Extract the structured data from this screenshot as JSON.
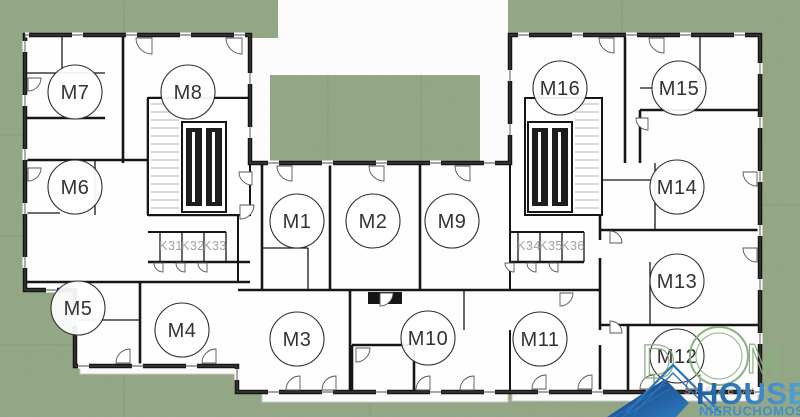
{
  "units": [
    "M1",
    "M2",
    "M3",
    "M4",
    "M5",
    "M6",
    "M7",
    "M8",
    "M9",
    "M10",
    "M11",
    "M12",
    "M13",
    "M14",
    "M15",
    "M16"
  ],
  "storage_units": [
    "K31",
    "K32",
    "K33",
    "K34",
    "K35",
    "K36"
  ],
  "logo": {
    "dom_letters": [
      "D",
      "O",
      "M"
    ],
    "house": "HOUSE",
    "subtitle": "NIERUCHOMOŚCI",
    "watermark": "SPRZEDAŻ"
  },
  "colors": {
    "grass": "#8EA37F",
    "grass-dark": "#7C9472",
    "wall": "#161616",
    "unit-text": "#333333",
    "storage-text": "#A0A0A0",
    "logo-green": "#8CB184",
    "logo-blue": "#2167AE",
    "logo-light-blue": "#4E9CD5",
    "logo-subtitle": "#4090C8",
    "watermark": "#B9B9B9"
  }
}
